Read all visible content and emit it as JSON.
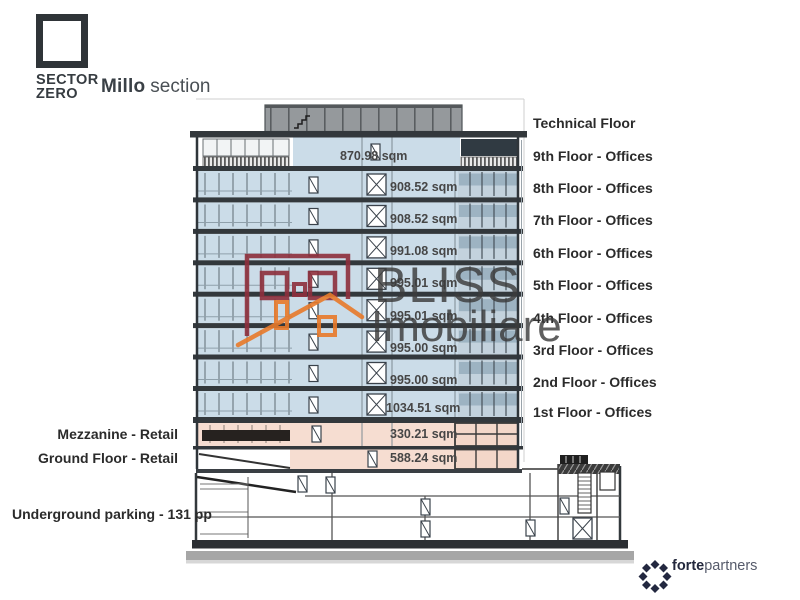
{
  "header": {
    "logo_line1": "SECTOR",
    "logo_line2": "ZERO",
    "title_bold": "Millo",
    "title_regular": "section"
  },
  "right_labels": [
    "Technical Floor",
    "9th Floor - Offices",
    "8th Floor - Offices",
    "7th Floor - Offices",
    "6th Floor - Offices",
    "5th Floor - Offices",
    "4th Floor - Offices",
    "3rd Floor - Offices",
    "2nd Floor - Offices",
    "1st Floor - Offices"
  ],
  "left_labels": [
    "Mezzanine - Retail",
    "Ground Floor - Retail",
    "Underground parking - 131 pp"
  ],
  "area_labels": [
    "870.98 sqm",
    "908.52 sqm",
    "908.52 sqm",
    "991.08 sqm",
    "995.01 sqm",
    "995.01 sqm",
    "995.00 sqm",
    "995.00 sqm",
    "1034.51 sqm",
    "330.21 sqm",
    "588.24 sqm"
  ],
  "watermark": {
    "line1": "BLISS",
    "line2": "Imobiliare"
  },
  "footer": {
    "brand_bold": "forte",
    "brand_regular": "partners"
  },
  "colors": {
    "office_fill": "#cbdce8",
    "retail_fill": "#f6ddd1",
    "slab": "#33383c",
    "technical_gray": "#95999c",
    "watermark_red": "#8e2f3c",
    "watermark_orange": "#e87a2a",
    "brand_navy": "#232840"
  }
}
